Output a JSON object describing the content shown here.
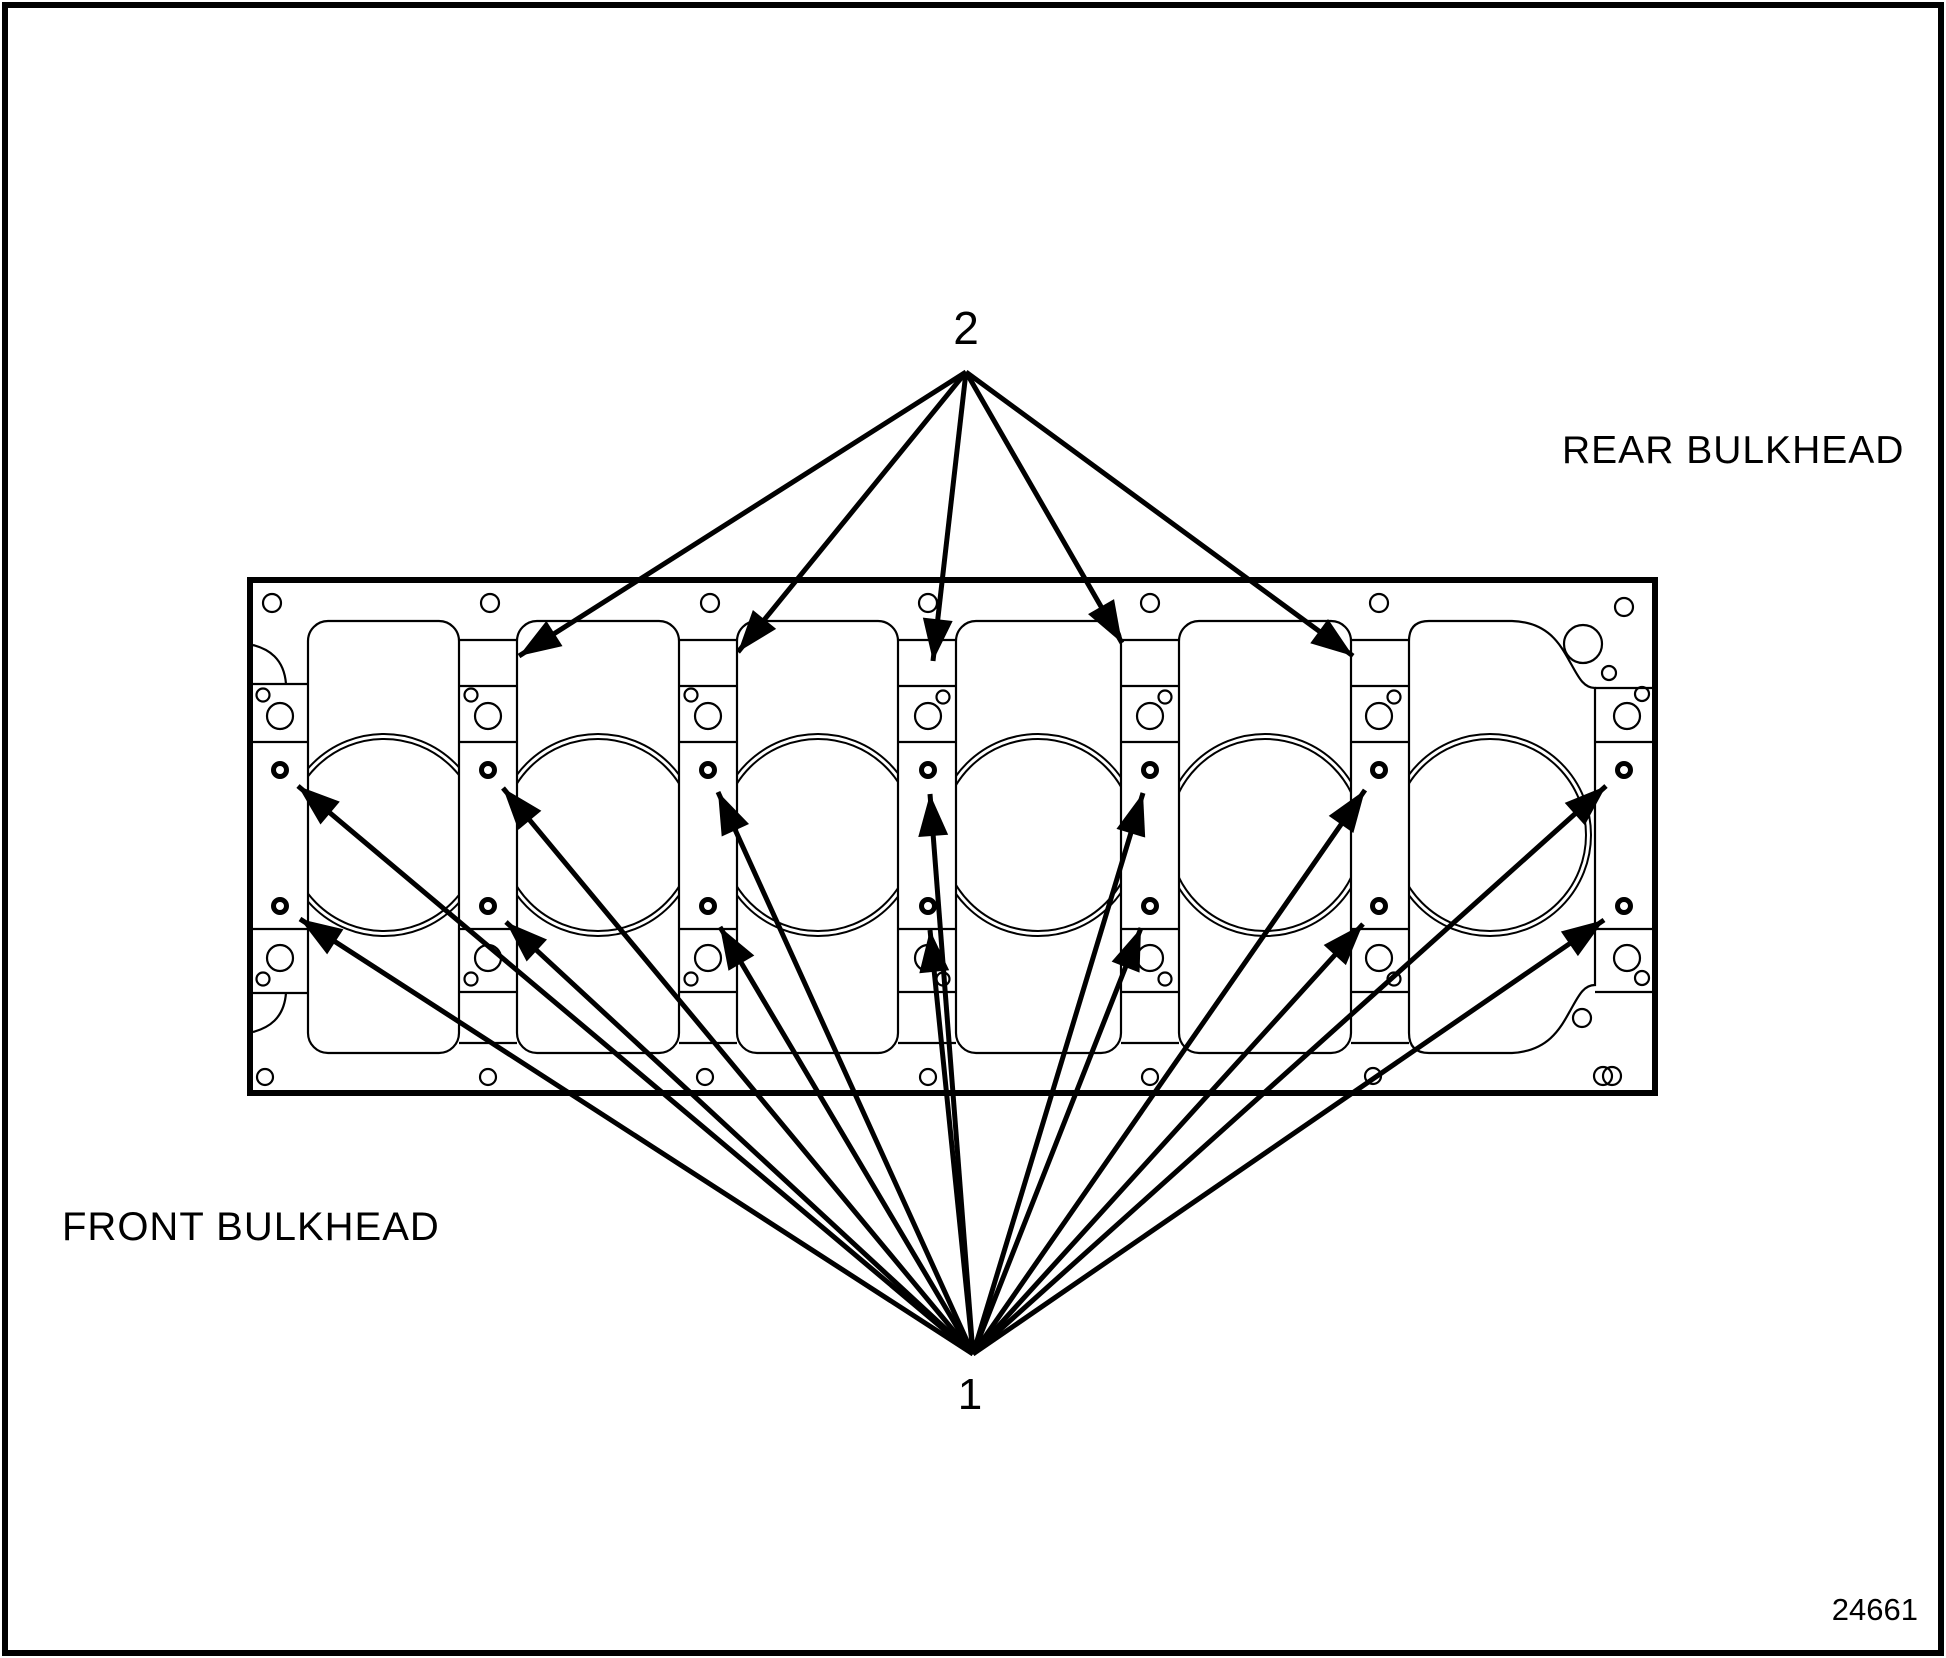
{
  "figure_number": "24661",
  "labels": {
    "rear_bulkhead": "REAR BULKHEAD",
    "front_bulkhead": "FRONT BULKHEAD"
  },
  "callouts": [
    {
      "number": "1",
      "arrow_count": 14
    },
    {
      "number": "2",
      "arrow_count": 5
    }
  ],
  "colors": {
    "line": "#000000",
    "background": "#ffffff"
  },
  "diagram": {
    "block": {
      "x": 250,
      "y": 580,
      "width": 1405,
      "height": 513
    },
    "windows_y": {
      "top": 621,
      "bottom": 1053
    },
    "bore": {
      "cy": 835,
      "r_outer": 101,
      "r_inner": 96,
      "centers_x": [
        384,
        598,
        818,
        1038,
        1265,
        1490
      ]
    },
    "ring_rows_y": [
      770,
      906
    ],
    "ring_columns_x": [
      280,
      488,
      708,
      928,
      1150,
      1379,
      1624
    ],
    "rings_style": {
      "r": 6.5,
      "stroke_width": 5
    },
    "hlines": [
      [
        250,
        308,
        684
      ],
      [
        250,
        308,
        742
      ],
      [
        250,
        308,
        929
      ],
      [
        250,
        308,
        993
      ],
      [
        459,
        517,
        640
      ],
      [
        459,
        517,
        686
      ],
      [
        459,
        517,
        742
      ],
      [
        459,
        517,
        929
      ],
      [
        459,
        517,
        992
      ],
      [
        459,
        517,
        1043
      ],
      [
        679,
        737,
        640
      ],
      [
        679,
        737,
        686
      ],
      [
        679,
        737,
        742
      ],
      [
        679,
        737,
        929
      ],
      [
        679,
        737,
        992
      ],
      [
        679,
        737,
        1043
      ],
      [
        898,
        956,
        640
      ],
      [
        898,
        956,
        686
      ],
      [
        898,
        956,
        742
      ],
      [
        898,
        956,
        929
      ],
      [
        898,
        956,
        992
      ],
      [
        898,
        956,
        1043
      ],
      [
        1121,
        1179,
        640
      ],
      [
        1121,
        1179,
        686
      ],
      [
        1121,
        1179,
        742
      ],
      [
        1121,
        1179,
        929
      ],
      [
        1121,
        1179,
        992
      ],
      [
        1121,
        1179,
        1043
      ],
      [
        1351,
        1409,
        640
      ],
      [
        1351,
        1409,
        686
      ],
      [
        1351,
        1409,
        742
      ],
      [
        1351,
        1409,
        929
      ],
      [
        1351,
        1409,
        992
      ],
      [
        1351,
        1409,
        1043
      ],
      [
        1595,
        1653,
        688
      ],
      [
        1595,
        1653,
        742
      ],
      [
        1595,
        1653,
        929
      ],
      [
        1595,
        1653,
        992
      ]
    ],
    "thin_circles": [
      [
        263,
        695,
        6.5
      ],
      [
        280,
        716,
        13
      ],
      [
        280,
        958,
        13
      ],
      [
        263,
        979,
        6.5
      ],
      [
        471,
        695,
        6.5
      ],
      [
        488,
        716,
        13
      ],
      [
        488,
        958,
        13
      ],
      [
        471,
        979,
        6.5
      ],
      [
        691,
        695,
        6.5
      ],
      [
        708,
        716,
        13
      ],
      [
        708,
        958,
        13
      ],
      [
        691,
        979,
        6.5
      ],
      [
        943,
        697,
        6.5
      ],
      [
        928,
        716,
        13
      ],
      [
        928,
        958,
        13
      ],
      [
        943,
        979,
        6.5
      ],
      [
        1165,
        697,
        6.5
      ],
      [
        1150,
        716,
        13
      ],
      [
        1150,
        958,
        13
      ],
      [
        1165,
        979,
        6.5
      ],
      [
        1394,
        697,
        6.5
      ],
      [
        1379,
        716,
        13
      ],
      [
        1379,
        958,
        13
      ],
      [
        1394,
        979,
        6.5
      ],
      [
        1642,
        694,
        7
      ],
      [
        1627,
        716,
        13
      ],
      [
        1627,
        958,
        13
      ],
      [
        1642,
        978,
        7
      ],
      [
        272,
        603,
        9
      ],
      [
        490,
        603,
        9
      ],
      [
        710,
        603,
        9
      ],
      [
        928,
        603,
        9
      ],
      [
        1150,
        603,
        9
      ],
      [
        1379,
        603,
        9
      ],
      [
        1624,
        607,
        9
      ],
      [
        265,
        1077,
        8
      ],
      [
        488,
        1077,
        8
      ],
      [
        705,
        1077,
        8
      ],
      [
        928,
        1077,
        8
      ],
      [
        1150,
        1077,
        8
      ],
      [
        1373,
        1076,
        8
      ],
      [
        1583,
        644,
        19
      ],
      [
        1609,
        673,
        7
      ],
      [
        1582,
        1018,
        9
      ],
      [
        1603,
        1076,
        9
      ],
      [
        1612,
        1076,
        9
      ]
    ],
    "arrow_sets": [
      {
        "callout": "2",
        "vertex": [
          966,
          372
        ],
        "tips": [
          [
            519,
            656
          ],
          [
            738,
            652
          ],
          [
            933,
            661
          ],
          [
            1122,
            643
          ],
          [
            1353,
            656
          ]
        ]
      },
      {
        "callout": "1",
        "vertex": [
          973,
          1354
        ],
        "tips": [
          [
            298,
            786
          ],
          [
            300,
            919
          ],
          [
            503,
            788
          ],
          [
            506,
            922
          ],
          [
            718,
            792
          ],
          [
            720,
            927
          ],
          [
            930,
            794
          ],
          [
            930,
            930
          ],
          [
            1143,
            793
          ],
          [
            1141,
            928
          ],
          [
            1365,
            790
          ],
          [
            1363,
            924
          ],
          [
            1606,
            786
          ],
          [
            1604,
            920
          ]
        ]
      }
    ]
  }
}
